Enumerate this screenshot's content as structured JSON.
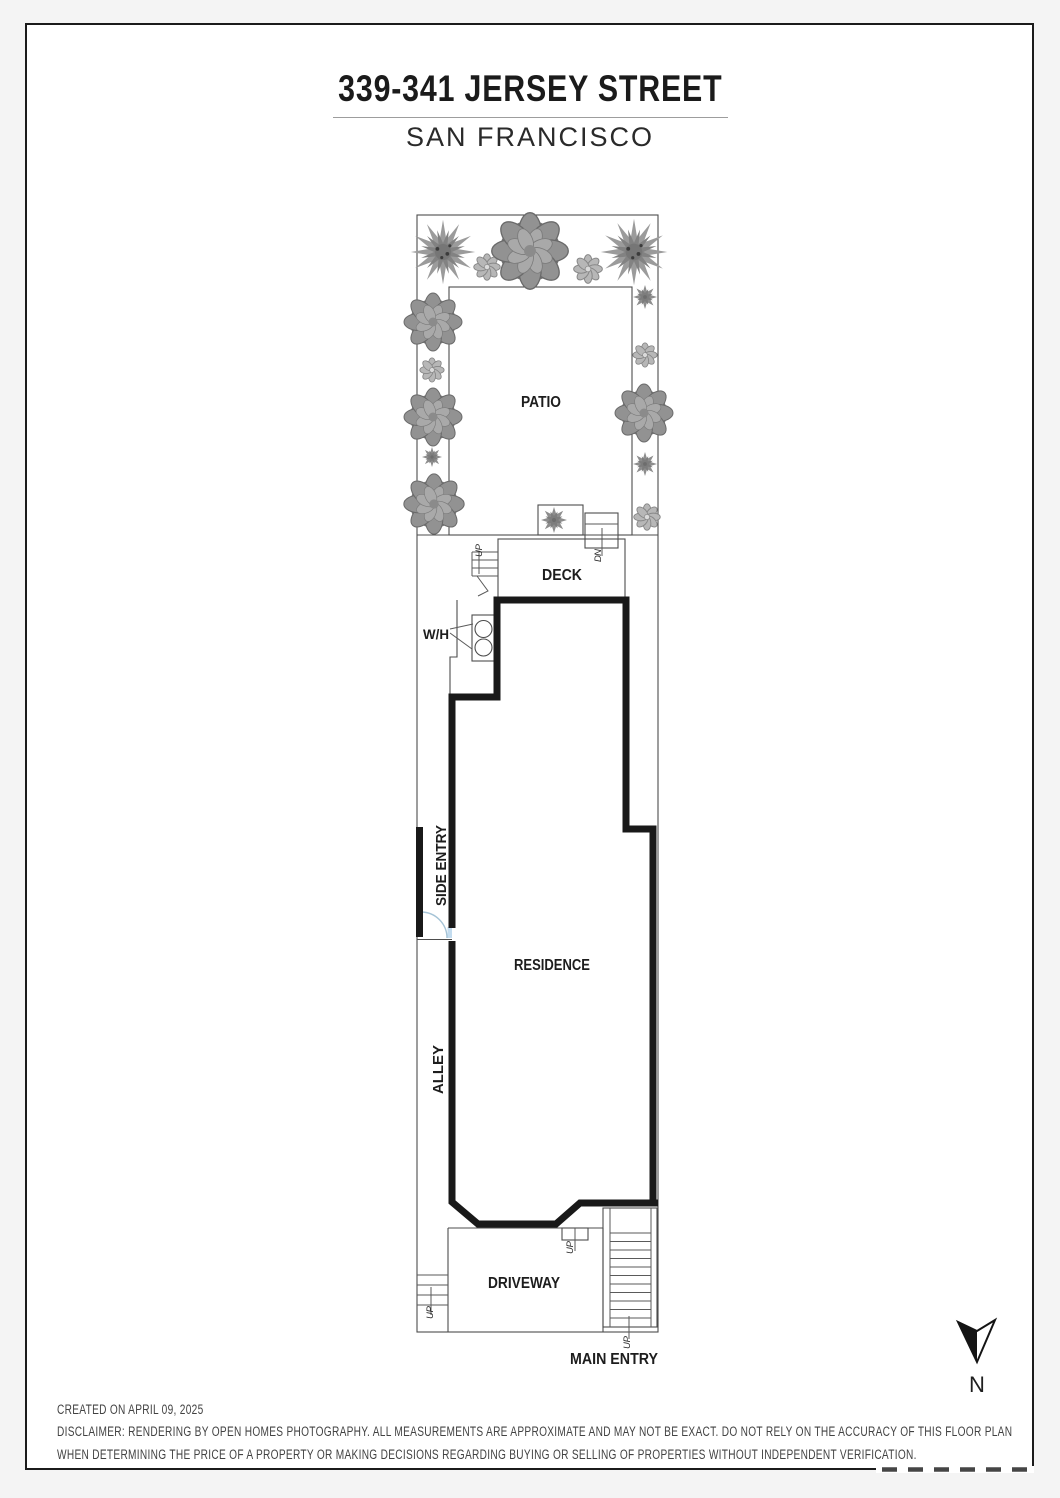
{
  "header": {
    "title": "339-341 JERSEY STREET",
    "subtitle": "SAN FRANCISCO"
  },
  "plan": {
    "labels": {
      "patio": "PATIO",
      "deck": "DECK",
      "residence": "RESIDENCE",
      "driveway": "DRIVEWAY",
      "main_entry": "MAIN ENTRY",
      "side_entry": "SIDE ENTRY",
      "alley": "ALLEY",
      "water_heater": "W/H",
      "up": "UP",
      "dn": "DN",
      "north": "N"
    },
    "plants": [
      {
        "type": "tree",
        "x": 443,
        "y": 252,
        "r": 31
      },
      {
        "type": "flower",
        "x": 487,
        "y": 267,
        "r": 12
      },
      {
        "type": "bush",
        "x": 530,
        "y": 251,
        "r": 33
      },
      {
        "type": "flower",
        "x": 588,
        "y": 269,
        "r": 13
      },
      {
        "type": "tree",
        "x": 634,
        "y": 252,
        "r": 32
      },
      {
        "type": "bush",
        "x": 433,
        "y": 322,
        "r": 25
      },
      {
        "type": "spiky",
        "x": 645,
        "y": 297,
        "r": 12
      },
      {
        "type": "flower",
        "x": 432,
        "y": 370,
        "r": 11
      },
      {
        "type": "flower",
        "x": 645,
        "y": 355,
        "r": 11
      },
      {
        "type": "bush",
        "x": 433,
        "y": 417,
        "r": 25
      },
      {
        "type": "bush",
        "x": 644,
        "y": 413,
        "r": 25
      },
      {
        "type": "spiky",
        "x": 432,
        "y": 457,
        "r": 10
      },
      {
        "type": "spiky",
        "x": 645,
        "y": 464,
        "r": 12
      },
      {
        "type": "bush",
        "x": 434,
        "y": 504,
        "r": 26
      },
      {
        "type": "flower",
        "x": 647,
        "y": 517,
        "r": 12
      },
      {
        "type": "spiky",
        "x": 554,
        "y": 520,
        "r": 13
      }
    ]
  },
  "footer": {
    "created": "CREATED ON APRIL 09, 2025",
    "disclaimer_line1": "DISCLAIMER: RENDERING BY OPEN HOMES PHOTOGRAPHY. ALL MEASUREMENTS ARE APPROXIMATE AND MAY NOT BE EXACT. DO NOT RELY ON THE ACCURACY OF THIS FLOOR PLAN",
    "disclaimer_line2": "WHEN DETERMINING THE PRICE OF A PROPERTY OR MAKING DECISIONS REGARDING BUYING OR SELLING OF PROPERTIES WITHOUT INDEPENDENT VERIFICATION."
  },
  "colors": {
    "wall": "#191919",
    "thin_line": "#4d4d4d",
    "door_accent": "#c3dcef",
    "paper": "#ffffff"
  }
}
